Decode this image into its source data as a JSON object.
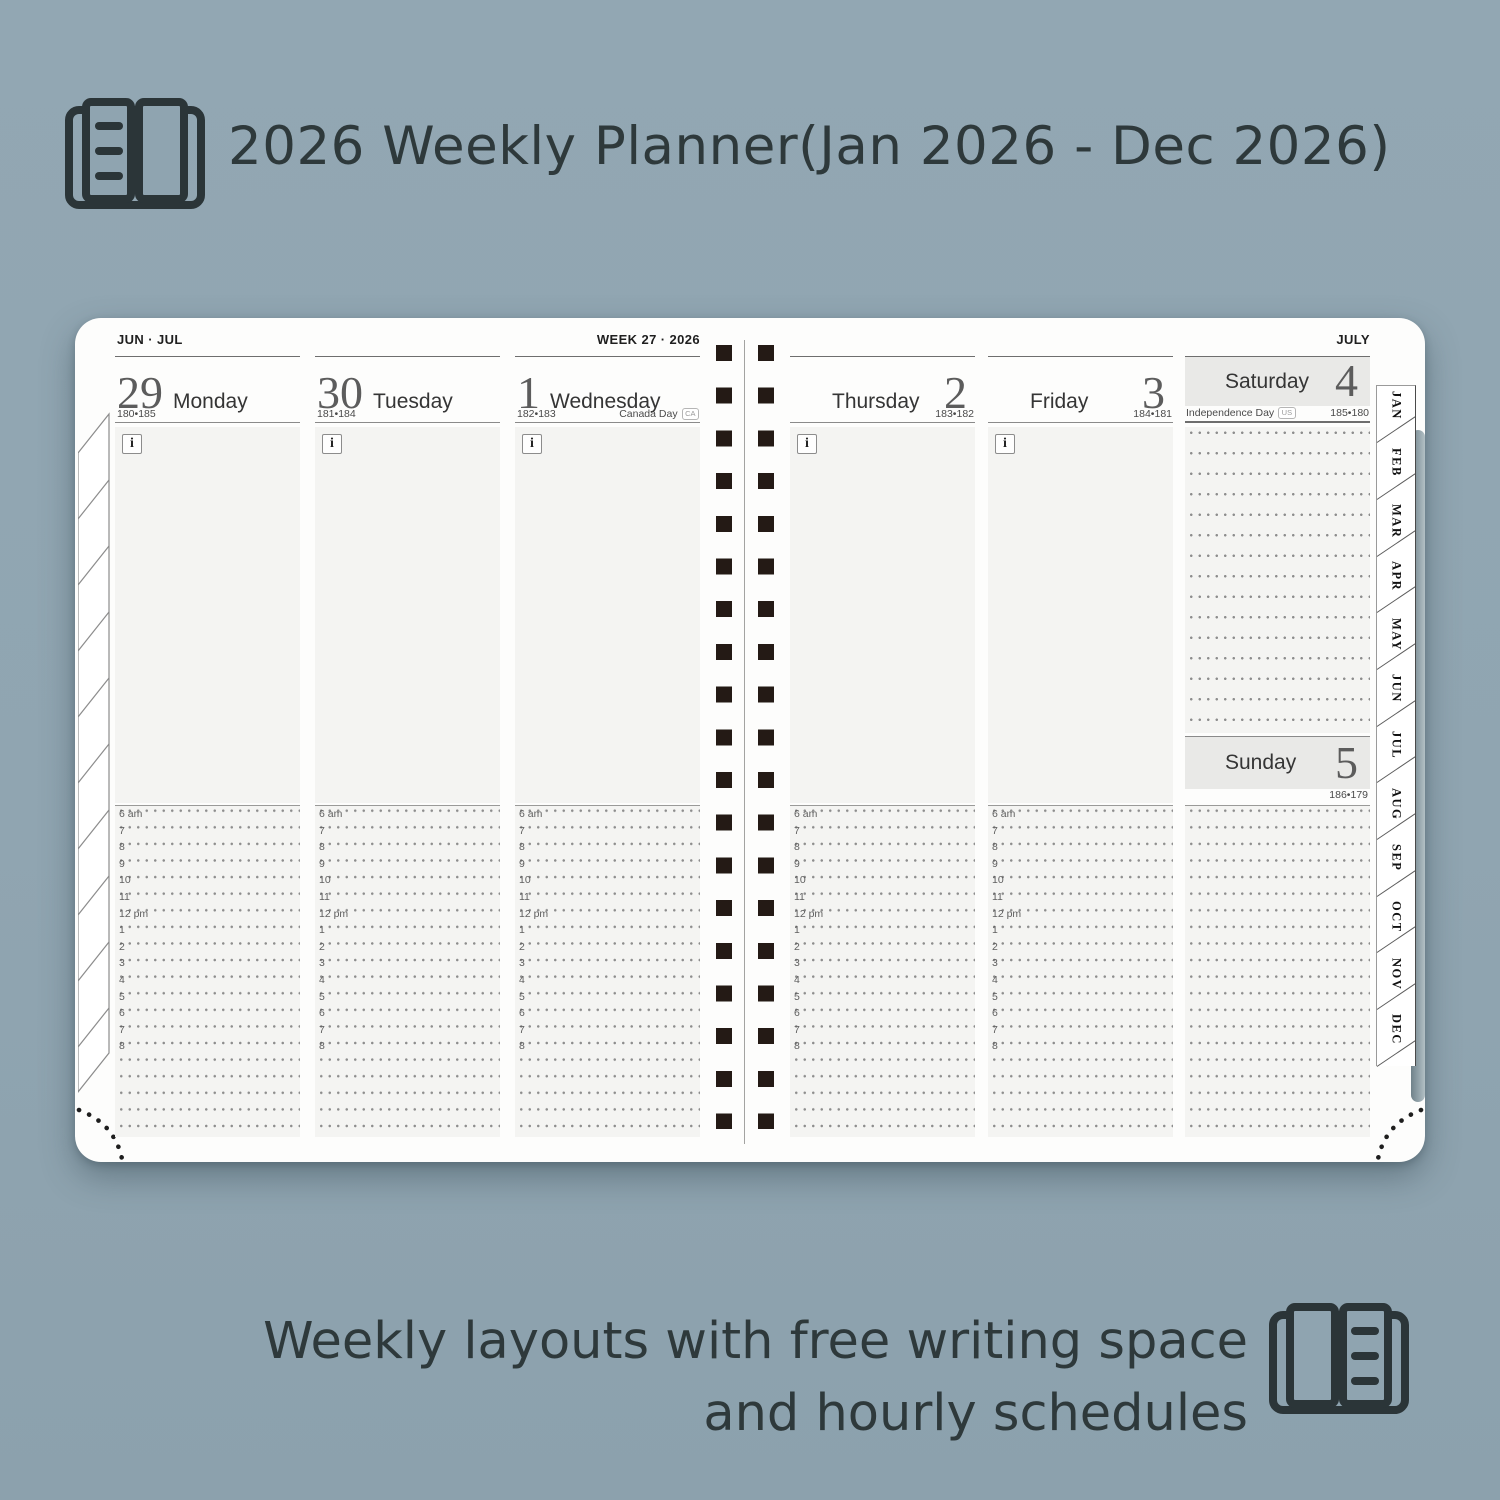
{
  "header": {
    "title": "2026 Weekly Planner(Jan 2026 - Dec 2026)"
  },
  "footer": {
    "line1": "Weekly layouts with free writing space",
    "line2": "and hourly schedules"
  },
  "planner": {
    "left_page": {
      "month_label": "JUN · JUL",
      "week_label": "WEEK 27 · 2026",
      "days": [
        {
          "number": "29",
          "name": "Monday",
          "day_count": "180•185"
        },
        {
          "number": "30",
          "name": "Tuesday",
          "day_count": "181•184"
        },
        {
          "number": "1",
          "name": "Wednesday",
          "day_count": "182•183",
          "holiday": "Canada Day",
          "holiday_badge": "CA"
        }
      ]
    },
    "right_page": {
      "month_label": "JULY",
      "days": [
        {
          "number": "2",
          "name": "Thursday",
          "day_count": "183•182"
        },
        {
          "number": "3",
          "name": "Friday",
          "day_count": "184•181"
        }
      ],
      "weekend": {
        "saturday": {
          "number": "4",
          "name": "Saturday",
          "holiday": "Independence Day",
          "holiday_badge": "US",
          "day_count": "185•180"
        },
        "sunday": {
          "number": "5",
          "name": "Sunday",
          "day_count": "186•179"
        }
      }
    },
    "info_icon": "i",
    "hours": [
      "6 am",
      "7",
      "8",
      "9",
      "10",
      "11",
      "12 pm",
      "1",
      "2",
      "3",
      "4",
      "5",
      "6",
      "7",
      "8"
    ],
    "month_tabs": [
      "JAN",
      "FEB",
      "MAR",
      "APR",
      "MAY",
      "JUN",
      "JUL",
      "AUG",
      "SEP",
      "OCT",
      "NOV",
      "DEC"
    ]
  },
  "colors": {
    "background": "#90a5b1",
    "caption_text": "#2e393b",
    "page": "#fdfdfc",
    "note_area": "#f4f4f2",
    "weekend_header": "#e9e9e7",
    "binding": "#241a15"
  }
}
